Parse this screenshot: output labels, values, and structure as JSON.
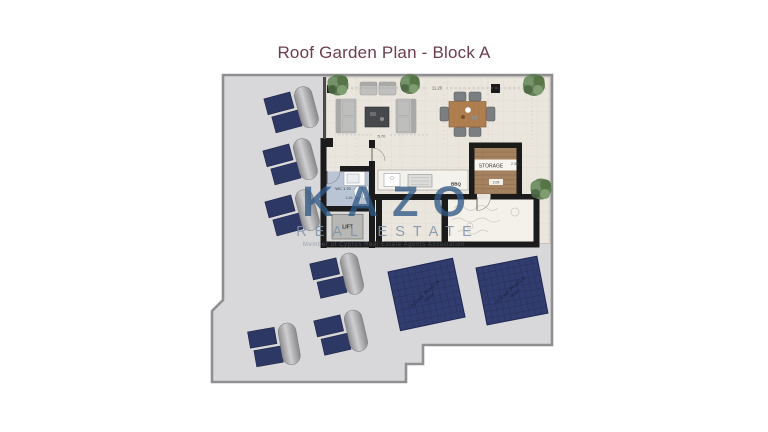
{
  "title": "Roof Garden Plan - Block A",
  "watermark": {
    "brand": "KAZO",
    "tagline": "REAL ESTATE",
    "subtext": "Member of Cyprus Real Estate Agents Association"
  },
  "plan": {
    "dimensions": {
      "top_width": "11.20",
      "living_width": "5.70"
    },
    "rooms": {
      "wc": {
        "label": "WC 1.70",
        "dim": "1.65"
      },
      "lift": {
        "label": "LIFT"
      },
      "bbq": {
        "label": "BBQ"
      },
      "storage": {
        "label": "STORAGE",
        "dim_width": "2.30",
        "dim_depth": "2.09"
      }
    },
    "solar_panels": {
      "label_line1": "SOLAR PANELS",
      "label_line2": "75x154"
    }
  }
}
